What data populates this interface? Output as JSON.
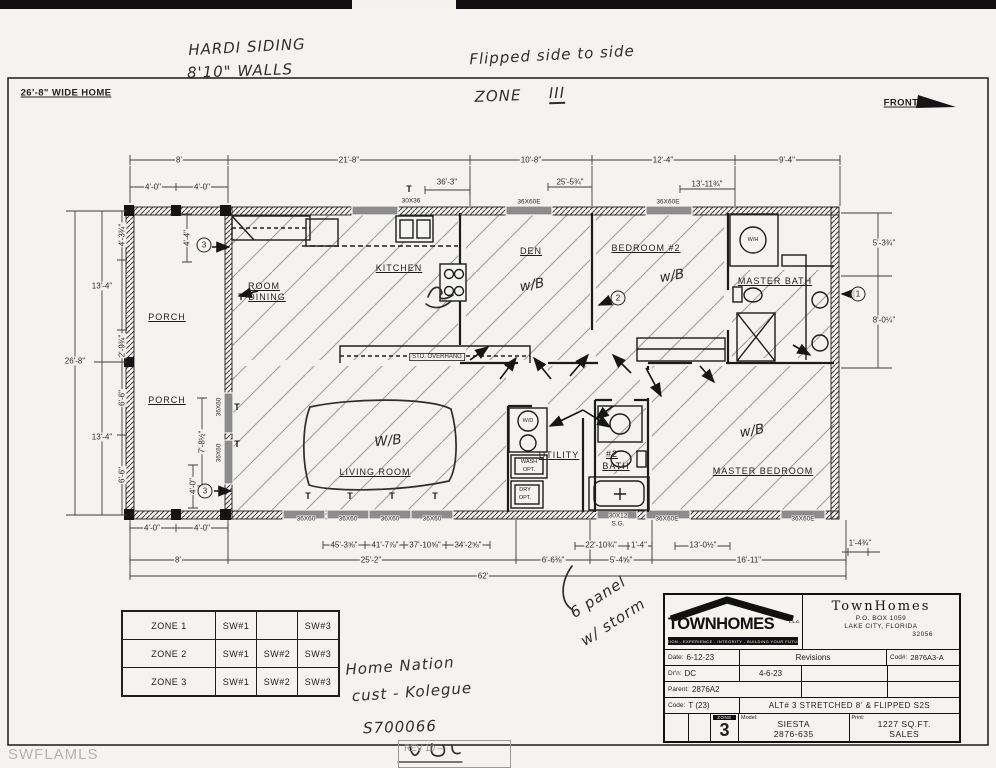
{
  "footer": {
    "watermark": "SWFLAMLS",
    "rev": "REV 10 —"
  },
  "zone_table": {
    "rows": [
      {
        "zone": "ZONE 1",
        "cells": [
          "SW#1",
          "",
          "SW#3"
        ]
      },
      {
        "zone": "ZONE 2",
        "cells": [
          "SW#1",
          "SW#2",
          "SW#3"
        ]
      },
      {
        "zone": "ZONE 3",
        "cells": [
          "SW#1",
          "SW#2",
          "SW#3"
        ]
      }
    ]
  },
  "title_block": {
    "logo_text": "TOWNHOMES",
    "logo_llc": "L.L.C.",
    "logo_tagline": "VISION - EXPERIENCE - INTEGRITY - BUILDING YOUR FUTURE",
    "company_name": "TownHomes",
    "address_line1": "P.O. BOX 1059",
    "address_line2": "LAKE CITY, FLORIDA",
    "address_line3": "32056",
    "date_label": "Date:",
    "date_value": "6-12-23",
    "revisions_label": "Revisions",
    "code_number_label": "Cod#:",
    "code_number_value": "2876A3-A",
    "drawn_label": "Dr'n:",
    "drawn_value": "DC",
    "revision1": "4-6-23",
    "parent_label": "Parent:",
    "parent_value": "2876A2",
    "code_label": "Code:",
    "code_value": "T (23)",
    "alt_text": "ALT# 3 STRETCHED 8' & FLIPPED S2S",
    "zone_tag": "ZONE",
    "zone_number": "3",
    "model_label": "Model:",
    "model_value1": "SIESTA",
    "model_value2": "2876-635",
    "print_label": "Print:",
    "print_value1": "1227 SQ.FT.",
    "print_value2": "SALES"
  },
  "annotations": [
    {
      "n": "hw-siding",
      "c": "hand",
      "x": 247,
      "y": 47,
      "r": -3,
      "t": "HARDI SIDING"
    },
    {
      "n": "hw-walls",
      "c": "hand",
      "x": 240,
      "y": 71,
      "r": -2,
      "t": "8'10\" WALLS"
    },
    {
      "n": "hw-flipped",
      "c": "hand",
      "x": 552,
      "y": 55,
      "r": -3,
      "t": "Flipped side to side"
    },
    {
      "n": "hw-zone-word",
      "c": "hand",
      "x": 498,
      "y": 96,
      "r": -2,
      "t": "ZONE"
    },
    {
      "n": "hw-zone-num",
      "c": "hand handu",
      "x": 557,
      "y": 94,
      "r": -2,
      "t": "III"
    },
    {
      "n": "wide-home-label",
      "c": "plain",
      "x": 66,
      "y": 93,
      "t": "26'-8\" WIDE HOME"
    },
    {
      "n": "front-label",
      "c": "plain",
      "x": 901,
      "y": 103,
      "t": "FRONT"
    },
    {
      "n": "dim-top-8",
      "c": "dim",
      "x": 179,
      "y": 160,
      "t": "8'"
    },
    {
      "n": "dim-top-21-8",
      "c": "dim",
      "x": 349,
      "y": 160,
      "t": "21'-8\""
    },
    {
      "n": "dim-top-10-8",
      "c": "dim",
      "x": 531,
      "y": 160,
      "t": "10'-8\""
    },
    {
      "n": "dim-top-12-4",
      "c": "dim",
      "x": 663,
      "y": 160,
      "t": "12'-4\""
    },
    {
      "n": "dim-top-9-4",
      "c": "dim",
      "x": 787,
      "y": 160,
      "t": "9'-4\""
    },
    {
      "n": "dim-top-4-0a",
      "c": "dim",
      "x": 153,
      "y": 187,
      "t": "4'-0\""
    },
    {
      "n": "dim-top-4-0b",
      "c": "dim",
      "x": 202,
      "y": 187,
      "t": "4'-0\""
    },
    {
      "n": "dim-top-36-3",
      "c": "dim",
      "x": 447,
      "y": 182,
      "t": "36'-3\""
    },
    {
      "n": "dim-top-25-5",
      "c": "dim",
      "x": 570,
      "y": 182,
      "t": "25'-5¾\""
    },
    {
      "n": "dim-top-13-11",
      "c": "dim",
      "x": 707,
      "y": 184,
      "t": "13'-11¾\""
    },
    {
      "n": "win-top-30x36",
      "c": "win",
      "x": 411,
      "y": 201,
      "t": "30X36"
    },
    {
      "n": "win-top-36x60e-1",
      "c": "win",
      "x": 529,
      "y": 202,
      "t": "36X60E"
    },
    {
      "n": "win-top-36x60e-2",
      "c": "win",
      "x": 668,
      "y": 202,
      "t": "36X60E"
    },
    {
      "n": "dim-left-13-4a",
      "c": "dim",
      "x": 102,
      "y": 286,
      "t": "13'-4\""
    },
    {
      "n": "dim-left-26-8",
      "c": "dim",
      "x": 75,
      "y": 361,
      "t": "26'-8\""
    },
    {
      "n": "dim-left-13-4b",
      "c": "dim",
      "x": 102,
      "y": 437,
      "t": "13'-4\""
    },
    {
      "n": "dim-left-4-3",
      "c": "dim",
      "x": 122,
      "y": 235,
      "r": -90,
      "t": "4'-3¾\""
    },
    {
      "n": "dim-left-2-9",
      "c": "dim",
      "x": 122,
      "y": 346,
      "r": -90,
      "t": "2'-9¾\""
    },
    {
      "n": "dim-left-6-6a",
      "c": "dim",
      "x": 122,
      "y": 398,
      "r": -90,
      "t": "6'-6\""
    },
    {
      "n": "dim-left-6-6b",
      "c": "dim",
      "x": 122,
      "y": 475,
      "r": -90,
      "t": "6'-6\""
    },
    {
      "n": "dim-porch-4-4",
      "c": "dim",
      "x": 187,
      "y": 238,
      "r": -90,
      "t": "4'-4\""
    },
    {
      "n": "dim-porch-7-8",
      "c": "dim",
      "x": 202,
      "y": 442,
      "r": -90,
      "t": "7'-8½\""
    },
    {
      "n": "dim-porch-4-0",
      "c": "dim",
      "x": 193,
      "y": 486,
      "r": -90,
      "t": "4'-0\""
    },
    {
      "n": "win-porch-1",
      "c": "win",
      "x": 219,
      "y": 407,
      "r": -90,
      "t": "36X60"
    },
    {
      "n": "win-porch-2",
      "c": "win",
      "x": 219,
      "y": 453,
      "r": -90,
      "t": "36X60"
    },
    {
      "n": "dim-right-5-3",
      "c": "dim",
      "x": 884,
      "y": 243,
      "t": "5'-3¾\""
    },
    {
      "n": "dim-right-8-0",
      "c": "dim",
      "x": 884,
      "y": 320,
      "t": "8'-0¼\""
    },
    {
      "n": "dim-bot-4-0a",
      "c": "dim",
      "x": 152,
      "y": 528,
      "t": "4'-0\""
    },
    {
      "n": "dim-bot-4-0b",
      "c": "dim",
      "x": 202,
      "y": 528,
      "t": "4'-0\""
    },
    {
      "n": "win-bot-1",
      "c": "win",
      "x": 306,
      "y": 519,
      "t": "36X60"
    },
    {
      "n": "win-bot-2",
      "c": "win",
      "x": 348,
      "y": 519,
      "t": "36X60"
    },
    {
      "n": "win-bot-3",
      "c": "win",
      "x": 390,
      "y": 519,
      "t": "36X60"
    },
    {
      "n": "win-bot-4",
      "c": "win",
      "x": 432,
      "y": 519,
      "t": "36X60"
    },
    {
      "n": "dim-bot-45-3",
      "c": "dim",
      "x": 344,
      "y": 545,
      "t": "45'-3⅝\""
    },
    {
      "n": "dim-bot-41-7",
      "c": "dim",
      "x": 385,
      "y": 545,
      "t": "41'-7⅞\""
    },
    {
      "n": "dim-bot-37-10",
      "c": "dim",
      "x": 425,
      "y": 545,
      "t": "37'-10⅝\""
    },
    {
      "n": "dim-bot-34-2",
      "c": "dim",
      "x": 468,
      "y": 545,
      "t": "34'-2⅝\""
    },
    {
      "n": "dim-bot-8",
      "c": "dim",
      "x": 178,
      "y": 560,
      "t": "8'"
    },
    {
      "n": "dim-bot-25-2",
      "c": "dim",
      "x": 371,
      "y": 560,
      "t": "25'-2\""
    },
    {
      "n": "dim-bot-6-6",
      "c": "dim",
      "x": 553,
      "y": 560,
      "t": "6'-6⅜\""
    },
    {
      "n": "dim-bot-5-4",
      "c": "dim",
      "x": 621,
      "y": 560,
      "t": "5'-4⅝\""
    },
    {
      "n": "dim-bot-16-11",
      "c": "dim",
      "x": 749,
      "y": 560,
      "t": "16'-11\""
    },
    {
      "n": "dim-bot-62",
      "c": "dim",
      "x": 483,
      "y": 576,
      "t": "62'"
    },
    {
      "n": "dim-bot-22-10",
      "c": "dim",
      "x": 601,
      "y": 545,
      "t": "22'-10¾\""
    },
    {
      "n": "dim-bot-1-4",
      "c": "dim",
      "x": 639,
      "y": 545,
      "t": "1'-4\""
    },
    {
      "n": "dim-bot-13-0",
      "c": "dim",
      "x": 703,
      "y": 545,
      "t": "13'-0½\""
    },
    {
      "n": "dim-bot-1-4b",
      "c": "dim",
      "x": 860,
      "y": 543,
      "t": "1'-4¾\""
    },
    {
      "n": "win-bot-30x12",
      "c": "win",
      "x": 618,
      "y": 516,
      "t": "30X12"
    },
    {
      "n": "win-bot-sg",
      "c": "win",
      "x": 618,
      "y": 524,
      "t": "S.G."
    },
    {
      "n": "win-bot-36x60e-1",
      "c": "win",
      "x": 667,
      "y": 519,
      "t": "36X60E"
    },
    {
      "n": "win-bot-36x60e-2",
      "c": "win",
      "x": 803,
      "y": 519,
      "t": "36X60E"
    },
    {
      "n": "room-porch-1",
      "c": "room",
      "x": 167,
      "y": 317,
      "t": "PORCH"
    },
    {
      "n": "room-porch-2",
      "c": "room",
      "x": 167,
      "y": 400,
      "t": "PORCH"
    },
    {
      "n": "room-dining-1",
      "c": "room",
      "x": 264,
      "y": 286,
      "t": "ROOM"
    },
    {
      "n": "room-dining-2",
      "c": "room",
      "x": 267,
      "y": 297,
      "t": "DINING"
    },
    {
      "n": "room-kitchen",
      "c": "room",
      "x": 399,
      "y": 268,
      "t": "KITCHEN"
    },
    {
      "n": "room-den",
      "c": "room",
      "x": 531,
      "y": 251,
      "t": "DEN"
    },
    {
      "n": "room-bedroom2",
      "c": "room",
      "x": 646,
      "y": 248,
      "t": "BEDROOM #2"
    },
    {
      "n": "room-master-bath",
      "c": "room",
      "x": 775,
      "y": 281,
      "t": "MASTER BATH"
    },
    {
      "n": "room-living",
      "c": "room",
      "x": 375,
      "y": 472,
      "t": "LIVING ROOM"
    },
    {
      "n": "room-utility",
      "c": "room",
      "x": 559,
      "y": 455,
      "t": "UTILITY"
    },
    {
      "n": "room-bath2-1",
      "c": "room",
      "x": 612,
      "y": 454,
      "t": "#2"
    },
    {
      "n": "room-bath2-2",
      "c": "room",
      "x": 616,
      "y": 466,
      "t": "BATH"
    },
    {
      "n": "room-master-bed",
      "c": "room",
      "x": 763,
      "y": 471,
      "t": "MASTER BEDROOM"
    },
    {
      "n": "label-std-overhang",
      "c": "winbg",
      "x": 437,
      "y": 357,
      "t": "STD. OVERHANG"
    },
    {
      "n": "label-wh",
      "c": "tiny",
      "x": 753,
      "y": 240,
      "t": "W/H"
    },
    {
      "n": "label-wd",
      "c": "tiny",
      "x": 528,
      "y": 421,
      "t": "W/D"
    },
    {
      "n": "label-wash-1",
      "c": "tiny",
      "x": 529,
      "y": 462,
      "t": "WASH"
    },
    {
      "n": "label-wash-2",
      "c": "tiny",
      "x": 529,
      "y": 470,
      "t": "OPT."
    },
    {
      "n": "label-dry-1",
      "c": "tiny",
      "x": 525,
      "y": 490,
      "t": "DRY"
    },
    {
      "n": "label-dry-2",
      "c": "tiny",
      "x": 525,
      "y": 498,
      "t": "OPT."
    },
    {
      "n": "hw-wb-den",
      "c": "handwb",
      "x": 532,
      "y": 285,
      "r": -10,
      "t": "w/B"
    },
    {
      "n": "hw-wb-bed2",
      "c": "handwb",
      "x": 672,
      "y": 276,
      "r": -10,
      "t": "w/B"
    },
    {
      "n": "hw-wb-living",
      "c": "handwb",
      "x": 388,
      "y": 441,
      "r": -6,
      "t": "W/B"
    },
    {
      "n": "hw-wb-master",
      "c": "handwb",
      "x": 752,
      "y": 431,
      "r": -10,
      "t": "w/B"
    },
    {
      "n": "circ-3-top",
      "c": "circ",
      "x": 204,
      "y": 245,
      "t": "3"
    },
    {
      "n": "circ-2",
      "c": "circ",
      "x": 618,
      "y": 298,
      "t": "2"
    },
    {
      "n": "circ-1",
      "c": "circ",
      "x": 858,
      "y": 294,
      "t": "1"
    },
    {
      "n": "circ-3-bottom",
      "c": "circ",
      "x": 205,
      "y": 491,
      "t": "3"
    },
    {
      "n": "t-mark-1",
      "c": "tmark",
      "x": 241,
      "y": 297,
      "t": "T"
    },
    {
      "n": "t-mark-2",
      "c": "tmark",
      "x": 409,
      "y": 189,
      "t": "T"
    },
    {
      "n": "t-mark-3",
      "c": "tmark",
      "x": 308,
      "y": 496,
      "t": "T"
    },
    {
      "n": "t-mark-4",
      "c": "tmark",
      "x": 350,
      "y": 496,
      "t": "T"
    },
    {
      "n": "t-mark-5",
      "c": "tmark",
      "x": 392,
      "y": 496,
      "t": "T"
    },
    {
      "n": "t-mark-6",
      "c": "tmark",
      "x": 435,
      "y": 496,
      "t": "T"
    },
    {
      "n": "t-mark-7",
      "c": "tmark",
      "x": 237,
      "y": 407,
      "t": "T"
    },
    {
      "n": "t-mark-8",
      "c": "tmark",
      "x": 237,
      "y": 444,
      "t": "T"
    },
    {
      "n": "hw-6panel-1",
      "c": "hand",
      "x": 598,
      "y": 597,
      "r": -33,
      "t": "6 panel"
    },
    {
      "n": "hw-6panel-2",
      "c": "hand",
      "x": 613,
      "y": 622,
      "r": -33,
      "t": "w/ storm"
    },
    {
      "n": "hw-customer-1",
      "c": "hand",
      "x": 400,
      "y": 666,
      "r": -4,
      "t": "Home Nation"
    },
    {
      "n": "hw-customer-2",
      "c": "hand",
      "x": 412,
      "y": 692,
      "r": -4,
      "t": "cust - Kolegue"
    },
    {
      "n": "hw-serial",
      "c": "hand",
      "x": 400,
      "y": 727,
      "r": -2,
      "t": "S700066"
    }
  ]
}
